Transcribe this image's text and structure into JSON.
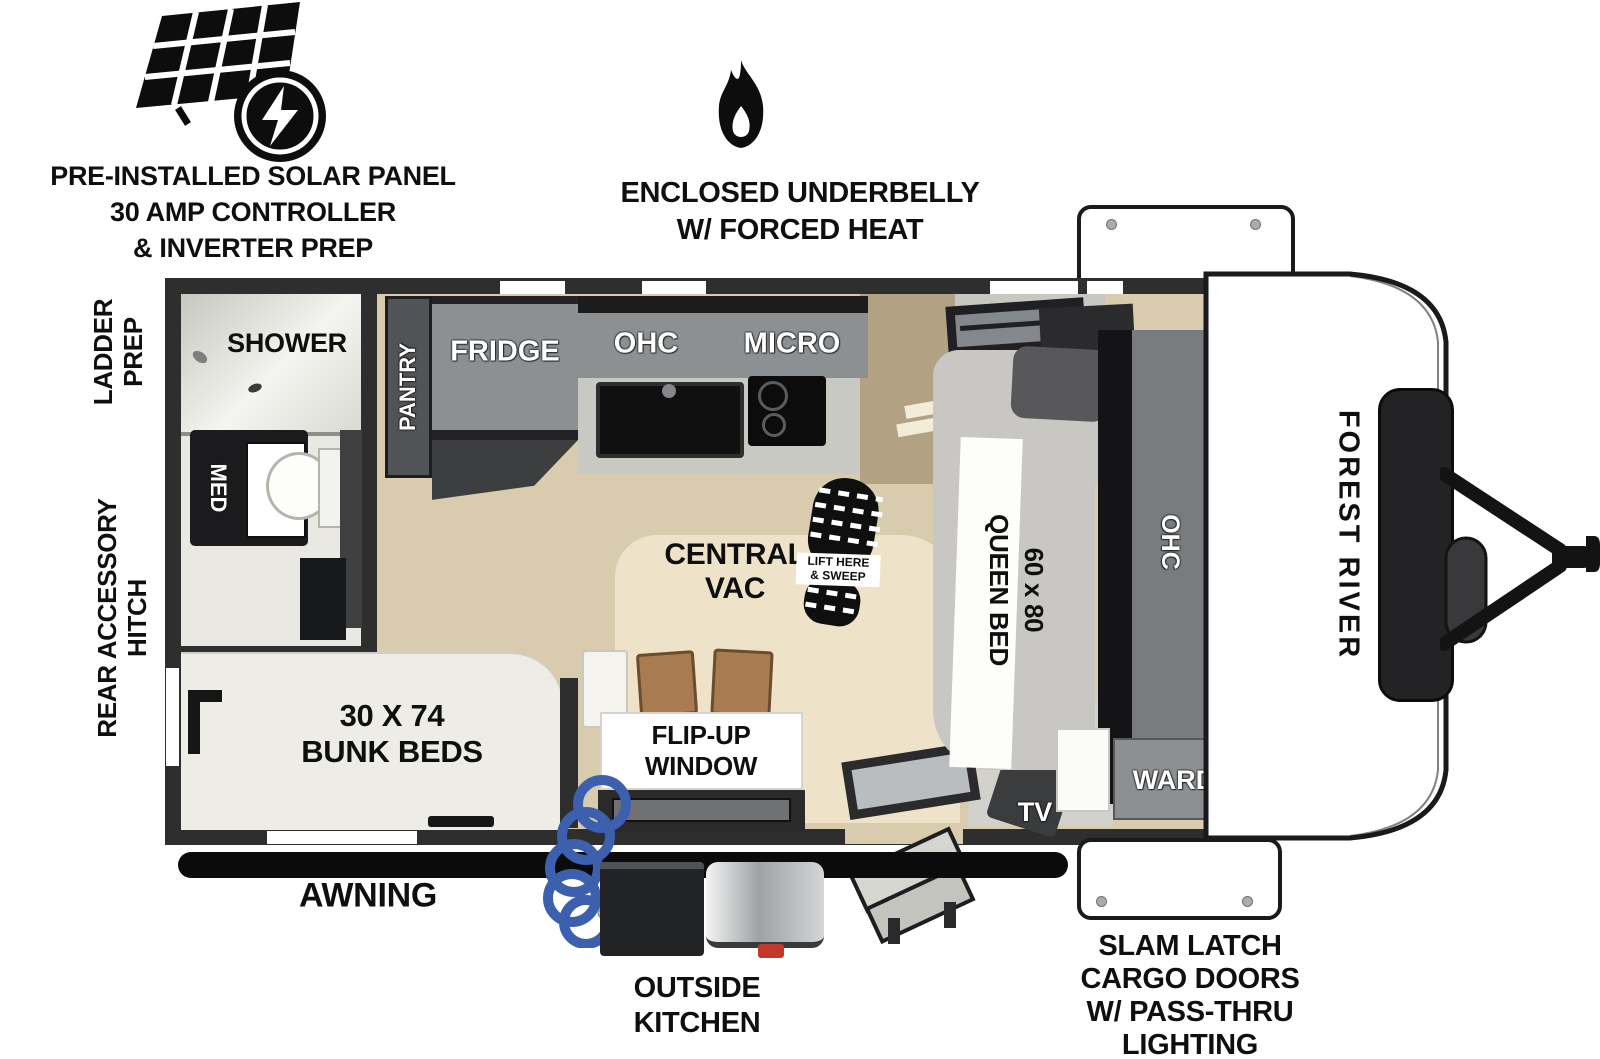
{
  "annotations": {
    "solar": {
      "lines": [
        "PRE-INSTALLED SOLAR PANEL",
        "30 AMP CONTROLLER",
        "& INVERTER PREP"
      ]
    },
    "underbelly": {
      "lines": [
        "ENCLOSED UNDERBELLY",
        "W/ FORCED HEAT"
      ]
    },
    "cargo_doors": {
      "lines": [
        "SLAM LATCH",
        "CARGO DOORS",
        "W/ PASS-THRU",
        "LIGHTING"
      ]
    },
    "outside_kitchen": {
      "lines": [
        "OUTSIDE",
        "KITCHEN"
      ]
    },
    "awning": "AWNING",
    "ladder_prep": {
      "lines": [
        "LADDER",
        "PREP"
      ]
    },
    "rear_hitch": {
      "lines": [
        "REAR ACCESSORY",
        "HITCH"
      ]
    }
  },
  "plan": {
    "shower": "SHOWER",
    "med": "MED",
    "pantry": "PANTRY",
    "fridge": "FRIDGE",
    "ohc": "OHC",
    "micro": "MICRO",
    "central_vac": {
      "lines": [
        "CENTRAL",
        "VAC"
      ]
    },
    "sweep": {
      "lines": [
        "LIFT HERE",
        "& SWEEP"
      ]
    },
    "flip_window": {
      "lines": [
        "FLIP-UP",
        "WINDOW"
      ]
    },
    "bunk": {
      "lines": [
        "30 X 74",
        "BUNK BEDS"
      ]
    },
    "queen": {
      "lines": [
        "60 x 80",
        "QUEEN BED"
      ]
    },
    "bed_ohc": "OHC",
    "ward": "WARD",
    "tv": "TV",
    "brand": "FOREST RIVER"
  },
  "colors": {
    "ink": "#0f0f10",
    "wall": "#2e2e2f",
    "floor": "#d8cbae",
    "floor_wood": "#b3a184",
    "floor_gray": "#c8c7c2",
    "rug": "#eee3c9",
    "cab_gray": "#8d9092",
    "cab_dark": "#47494b",
    "counter_black": "#121213",
    "bed_gray": "#c8c7c3",
    "pillow_gray": "#58585a",
    "bunk_white": "#edece6",
    "hose_blue": "#3c5fae",
    "steel": "#c3c6c9",
    "cap_white": "#ffffff"
  }
}
